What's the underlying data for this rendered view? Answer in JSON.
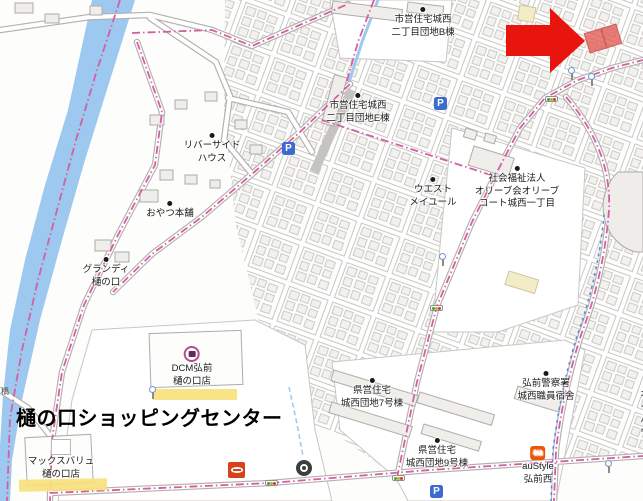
{
  "colors": {
    "arrow_red": "#e8150f",
    "target_red": "#e25a52",
    "highlight_yellow": "#f7e17d",
    "boundary_pink": "#d45fa2",
    "river_blue": "#9dc8ef",
    "parking_blue": "#3a6cd0",
    "au_orange": "#eb5505",
    "store_red": "#d8411a",
    "dcm_magenta": "#b94a8c",
    "lamp_blue": "#6d97d4"
  },
  "title_overlay": {
    "text": "樋の口ショッピングセンター"
  },
  "labels": {
    "shiei_b": {
      "text": "市営住宅城西\n二丁目団地B棟"
    },
    "shiei_e": {
      "text": "市営住宅城西\n二丁目団地E棟"
    },
    "riverside": {
      "text": "リバーサイド\nハウス"
    },
    "oyatsu": {
      "text": "おやつ本舗"
    },
    "grandi": {
      "text": "グランディ\n樋の口"
    },
    "west_meilleur": {
      "text": "ウエスト\nメイユール"
    },
    "olive": {
      "text": "社会福祉法人\nオリーブ会オリーブ\nコート城西一丁目"
    },
    "kenei7": {
      "text": "県営住宅\n城西団地7号棟"
    },
    "kenei9": {
      "text": "県営住宅\n城西団地9号棟"
    },
    "police": {
      "text": "弘前警察署\n城西職員宿舎"
    },
    "dcm": {
      "text": "DCM弘前\n樋の口店"
    },
    "maxvalu": {
      "text": "マックスバリュ\n樋の口店"
    },
    "austyle": {
      "text": "auStyle\n弘前西"
    },
    "edge_right": {
      "text": "オー\nハウ"
    },
    "bridge": {
      "text": "橋"
    }
  },
  "icons": {
    "parking_letter": "P",
    "au_text": "au"
  }
}
